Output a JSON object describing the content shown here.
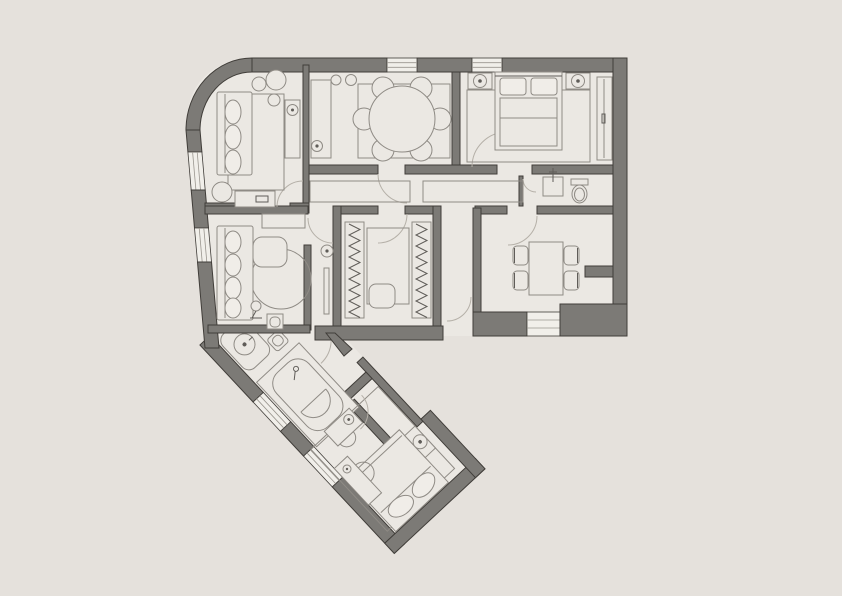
{
  "app": {
    "type": "architectural-floor-plan",
    "title": "apartment-floor-plan",
    "visible_text": ""
  },
  "palette": {
    "background": "#e5e1dc",
    "floor": "#ebe8e3",
    "wall_fill": "#7c7a76",
    "wall_outline": "#403d39",
    "window_fill": "#f1efea",
    "window_line": "#9a968f",
    "furniture_line": "#8f8b85",
    "furniture_dark": "#5f5c58",
    "soft_fill": "#f0ede8",
    "door_arc": "#b5b0a8"
  },
  "plan": {
    "style": "top-down 2D plan, gray walls on warm-gray paper, rounded top-left corner, rotated wing at bottom",
    "windows_count": 7,
    "doors_count": 10,
    "rooms": [
      {
        "name": "lounge",
        "position": "top-left",
        "furniture": [
          "sofa",
          "rug",
          "plants",
          "console-with-lamp",
          "media-cabinet",
          "floor-plant"
        ]
      },
      {
        "name": "family-room",
        "position": "top-middle",
        "furniture": [
          "round-dining-table",
          "six-chairs",
          "tall-cabinet",
          "two-pendant-lamps",
          "rug"
        ]
      },
      {
        "name": "master-bedroom",
        "position": "top-right",
        "furniture": [
          "double-bed",
          "two-nightstands-with-lamps",
          "wardrobe",
          "rug"
        ]
      },
      {
        "name": "corridor",
        "position": "middle",
        "furniture": [
          "built-in-cabinet",
          "built-in-cabinet"
        ]
      },
      {
        "name": "wc",
        "position": "middle-right-of-corridor",
        "furniture": [
          "washbasin",
          "toilet"
        ]
      },
      {
        "name": "sitting-room",
        "position": "middle-left",
        "furniture": [
          "sofa",
          "coffee-table",
          "round-rug",
          "sideboard",
          "floor-lamp",
          "wall-cabinet"
        ]
      },
      {
        "name": "walk-in-closet",
        "position": "middle-center",
        "furniture": [
          "clothes-rail",
          "clothes-rail",
          "rug",
          "ottoman"
        ]
      },
      {
        "name": "dining-room",
        "position": "middle-right",
        "furniture": [
          "table",
          "four-chairs"
        ]
      },
      {
        "name": "entry-hall",
        "position": "center",
        "furniture": [
          "front-door",
          "console-with-lamp"
        ]
      },
      {
        "name": "bathroom",
        "position": "wing-upper",
        "furniture": [
          "bathtub",
          "washbasin-counter",
          "round-stool",
          "small-cabinet"
        ]
      },
      {
        "name": "bedroom-2",
        "position": "wing-lower",
        "furniture": [
          "double-bed",
          "nightstand-with-lamp",
          "dresser-with-lamp",
          "vanity-with-chair",
          "rug"
        ]
      }
    ]
  }
}
